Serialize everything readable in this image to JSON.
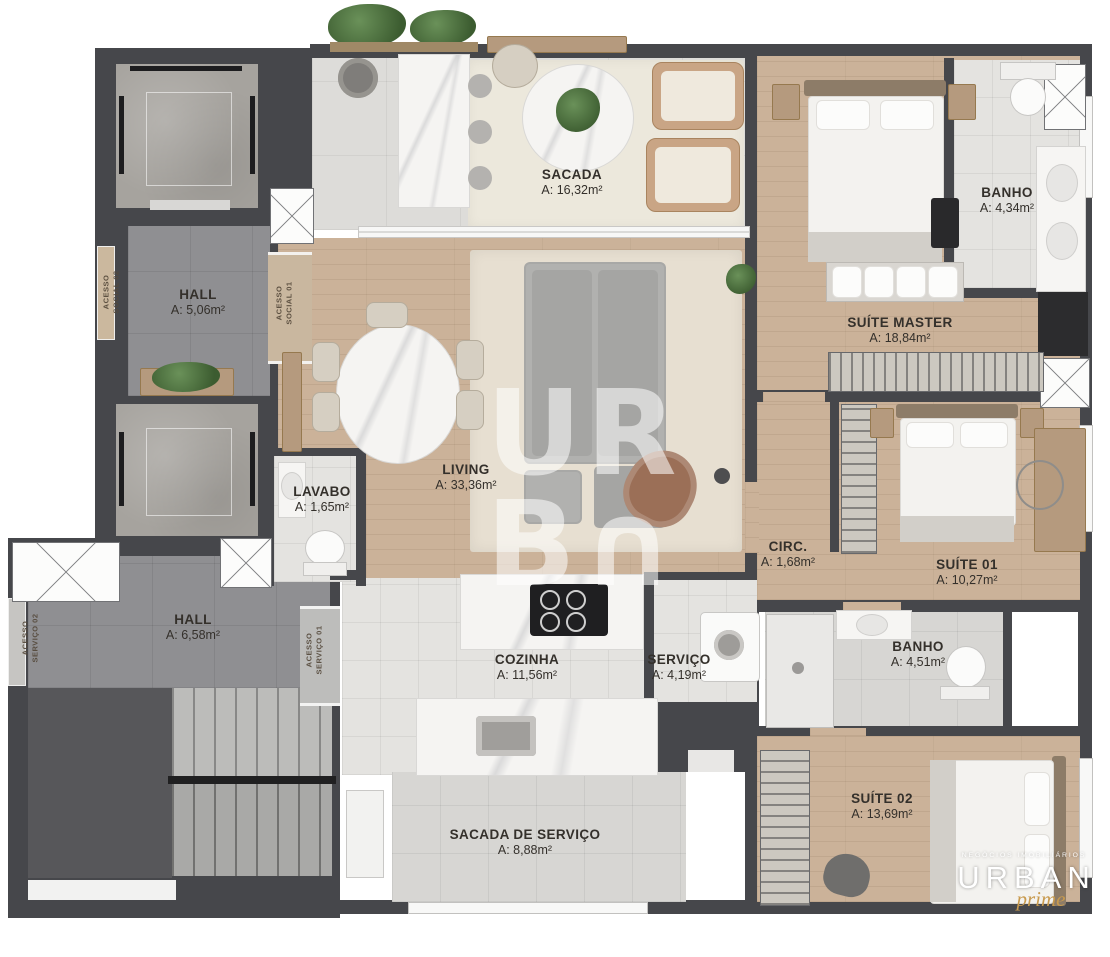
{
  "plan": {
    "rooms": [
      {
        "name": "SACADA",
        "area": "A: 16,32m²"
      },
      {
        "name": "HALL",
        "area": "A: 5,06m²"
      },
      {
        "name": "BANHO",
        "area": "A: 4,34m²"
      },
      {
        "name": "SUÍTE MASTER",
        "area": "A: 18,84m²"
      },
      {
        "name": "LIVING",
        "area": "A: 33,36m²"
      },
      {
        "name": "LAVABO",
        "area": "A: 1,65m²"
      },
      {
        "name": "CIRC.",
        "area": "A: 1,68m²"
      },
      {
        "name": "SUÍTE 01",
        "area": "A: 10,27m²"
      },
      {
        "name": "HALL",
        "area": "A: 6,58m²"
      },
      {
        "name": "COZINHA",
        "area": "A: 11,56m²"
      },
      {
        "name": "SERVIÇO",
        "area": "A: 4,19m²"
      },
      {
        "name": "BANHO",
        "area": "A: 4,51m²"
      },
      {
        "name": "SUÍTE 02",
        "area": "A: 13,69m²"
      },
      {
        "name": "SACADA DE SERVIÇO",
        "area": "A: 8,88m²"
      }
    ],
    "accesses": [
      {
        "label": "ACESSO\nSOCIAL 02"
      },
      {
        "label": "ACESSO\nSOCIAL 01"
      },
      {
        "label": "ACESSO\nSERVIÇO 02"
      },
      {
        "label": "ACESSO\nSERVIÇO 01"
      }
    ],
    "watermark": "UR\nB∩",
    "brand": {
      "tagline": "NEGÓCIOS IMOBILIÁRIOS",
      "name": "URBAN",
      "sub": "prime"
    },
    "colors": {
      "wall": "#46474b",
      "wood_floor": "#cbb299",
      "light_tile": "#e4e3e0",
      "hall_tile": "#8f8f92",
      "rug": "#ece8dc",
      "brand_gold": "#c89a4e",
      "watermark_white": "rgba(255,255,255,0.55)",
      "label_text": "#34302b"
    }
  }
}
